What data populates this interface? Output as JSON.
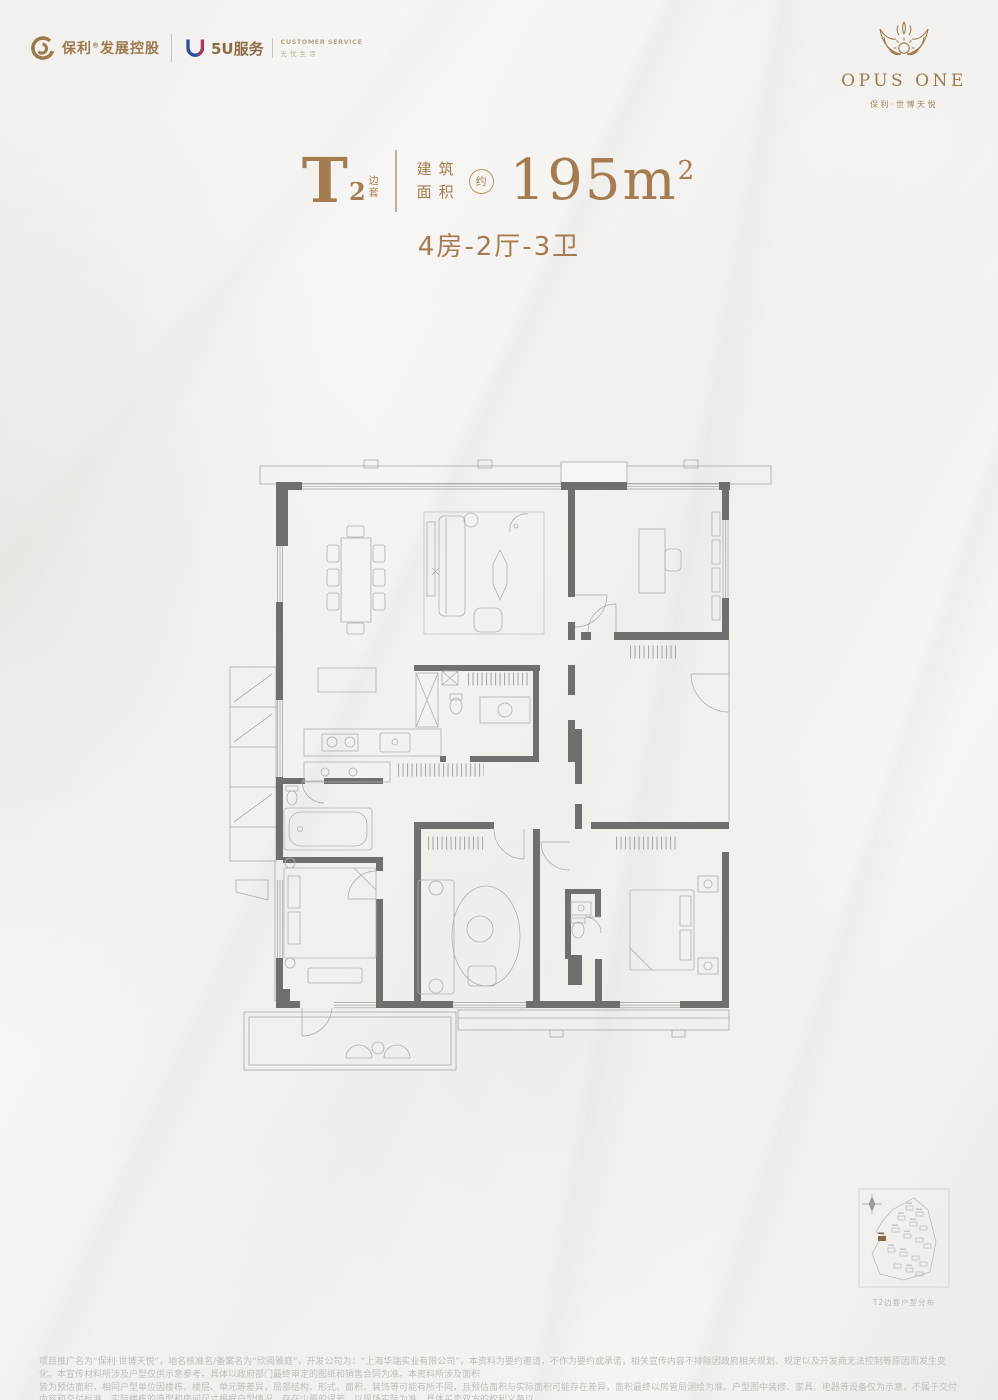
{
  "colors": {
    "bronze": "#a57c4f",
    "header_gold": "#9c7a4e",
    "wall_gray": "#6f6f70",
    "furniture_line": "#b1b0ac",
    "disclaimer_text": "#c0beb9",
    "logo_blue": "#2f4f9f",
    "logo_red": "#ad3a56"
  },
  "header_left": {
    "poly_name": "保利",
    "poly_reg": "®",
    "poly_suffix": "发展控股",
    "service_name": "5U服务",
    "service_en": "CUSTOMER SERVICE",
    "service_cn": "无忧生活"
  },
  "header_right": {
    "brand": "OPUS ONE",
    "project": "保利·世博天悦"
  },
  "unit_title": {
    "type_letter": "T",
    "type_number": "2",
    "type_tag_1": "边",
    "type_tag_2": "套",
    "area_label_line1": "建筑",
    "area_label_line2": "面积",
    "approx_char": "约",
    "area_number": "195m",
    "area_exponent": "2",
    "rooms_summary": "4房-2厅-3卫"
  },
  "site_plan": {
    "caption": "T2边套户型分布"
  },
  "disclaimer": {
    "line1": "项目推广名为“保利·世博天悦”，地名核准名/备案名为“欣阅雅庭”，开发公司为：“上海华瑞实业有限公司”，本资料为要约邀请，不作为要约或承诺，相关宣传内容不排除因政府相关规划、规定以及开发商无法控制等原因而发生变化。本宣传材料所涉及户型仅供示意参考，具体以政府部门最终审定的图纸和销售合同为准。本资料所涉及面积",
    "line2": "皆为预估面积，相同户型单位因楼栋、楼层、单元等差异，局部结构、形式、面积、装饰等可能有所不同，且预估面积与实际面积可能存在差异，面积最终以房管局测绘为准。户型图中装修、家具、电器等设备仅为示意，不属于交付内容和交付标准，实际楼栋的造型和房间尺寸根据户型情况，存在少量的误差，以现场实际为准。具体买卖双方的权利义务以",
    "line3": "双方签订的《商品房买卖合同》及其补充协议、附件等书面文件为准。本资料所发布内容为2024年3月31日前的信息，于2024年4月印刷，敬请留意。"
  }
}
